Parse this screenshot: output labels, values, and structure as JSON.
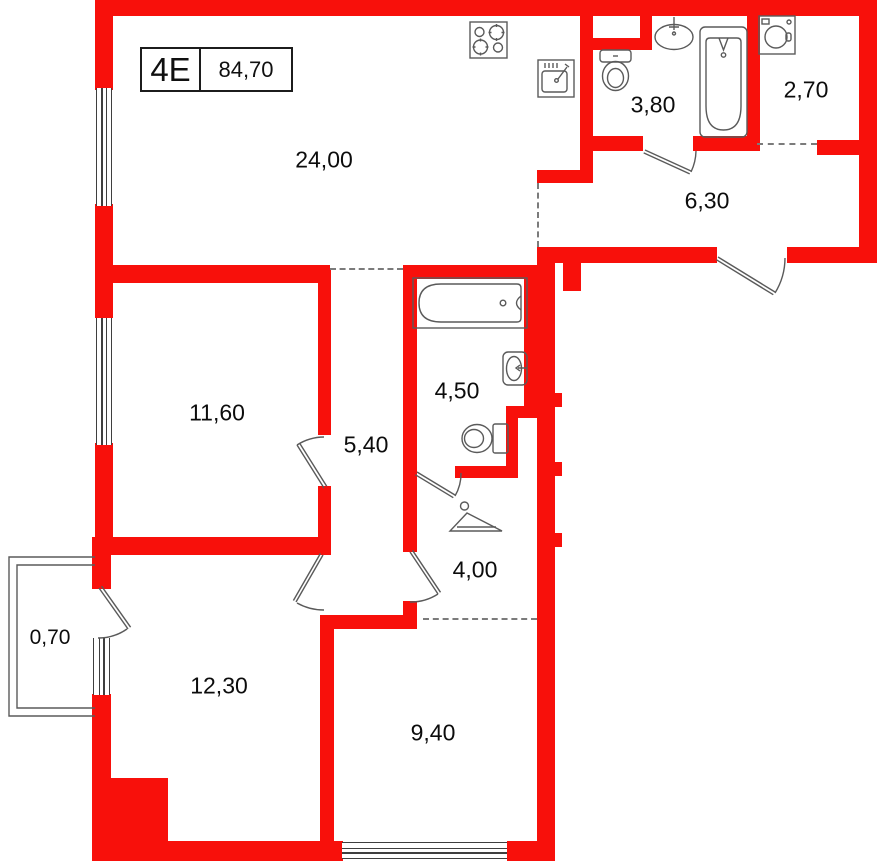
{
  "title_block": {
    "unit": "4E",
    "area": "84,70"
  },
  "rooms": {
    "kitchen_living": "24,00",
    "wc": "3,80",
    "laundry": "2,70",
    "hallway": "6,30",
    "bedroom1": "11,60",
    "corridor": "5,40",
    "bathroom": "4,50",
    "hall": "4,00",
    "bedroom2": "12,30",
    "balcony": "0,70",
    "room940": "9,40"
  },
  "fixtures": {
    "kitchen_living": [
      "stove-icon",
      "kitchen-sink-icon"
    ],
    "wc": [
      "toilet-icon",
      "wash-basin-icon",
      "bathtub-icon"
    ],
    "laundry": [
      "washing-machine-icon"
    ],
    "bathroom": [
      "bathtub-icon",
      "wash-basin-icon",
      "toilet-icon"
    ],
    "hall": [
      "clothes-hanger-icon"
    ]
  },
  "colors": {
    "wall": "#f8100b",
    "line": "#5a5a5a",
    "dash": "#7b7b7b",
    "text": "#0c0c0c"
  }
}
